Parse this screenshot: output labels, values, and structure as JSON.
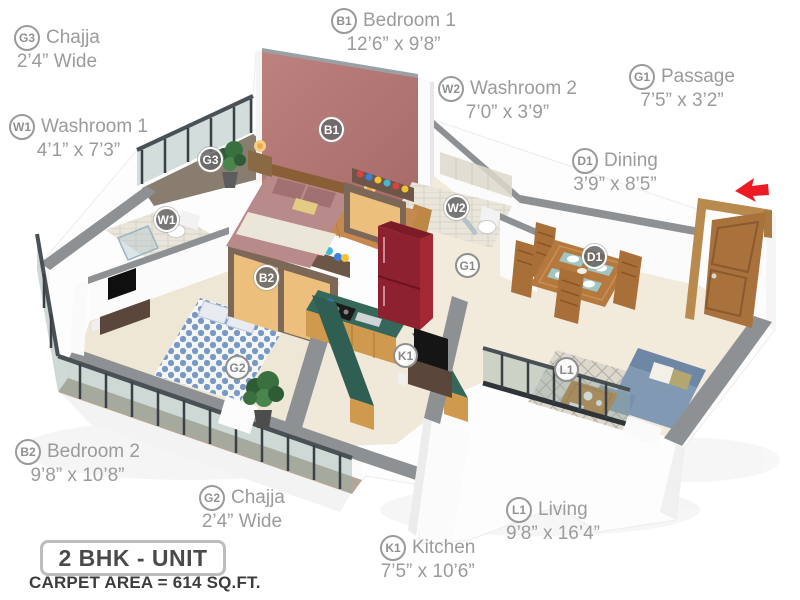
{
  "unit": {
    "title": "2 BHK - UNIT",
    "carpet_area": "CARPET AREA = 614 SQ.FT."
  },
  "rooms": [
    {
      "code": "B1",
      "name": "Bedroom 1",
      "dims": "12’6” x 9’8”"
    },
    {
      "code": "B2",
      "name": "Bedroom 2",
      "dims": "9’8” x 10’8”"
    },
    {
      "code": "W1",
      "name": "Washroom 1",
      "dims": "4’1” x 7’3”"
    },
    {
      "code": "W2",
      "name": "Washroom 2",
      "dims": "7’0” x 3’9”"
    },
    {
      "code": "K1",
      "name": "Kitchen",
      "dims": "7’5” x 10’6”"
    },
    {
      "code": "L1",
      "name": "Living",
      "dims": "9’8” x 16’4”"
    },
    {
      "code": "D1",
      "name": "Dining",
      "dims": "3’9” x 8’5”"
    },
    {
      "code": "G1",
      "name": "Passage",
      "dims": "7’5” x 3’2”"
    },
    {
      "code": "G2",
      "name": "Chajja",
      "dims": "2’4” Wide"
    },
    {
      "code": "G3",
      "name": "Chajja",
      "dims": "2’4” Wide"
    }
  ],
  "icons": {
    "entry_arrow": "entry-direction-arrow"
  },
  "colors": {
    "maroon_wall": "#b17372",
    "wall_gray": "#8d9194",
    "floor_cream": "#f2ebdc",
    "floor_wood": "#c68a50",
    "counter_green": "#35685a",
    "cabinet_wood": "#cf9a4e",
    "fridge_red": "#8e2130",
    "sofa_blue": "#8299b3",
    "sofa_blue_dark": "#6d87a4",
    "bed1_rose": "#b98a8a",
    "bed2_dot": "#7094c4",
    "wood": "#b5793f",
    "wood_dark": "#8a5f36",
    "arrow_red": "#ed1c24",
    "label_gray": "#9b9b9b",
    "text_dark": "#4a4a4a"
  }
}
